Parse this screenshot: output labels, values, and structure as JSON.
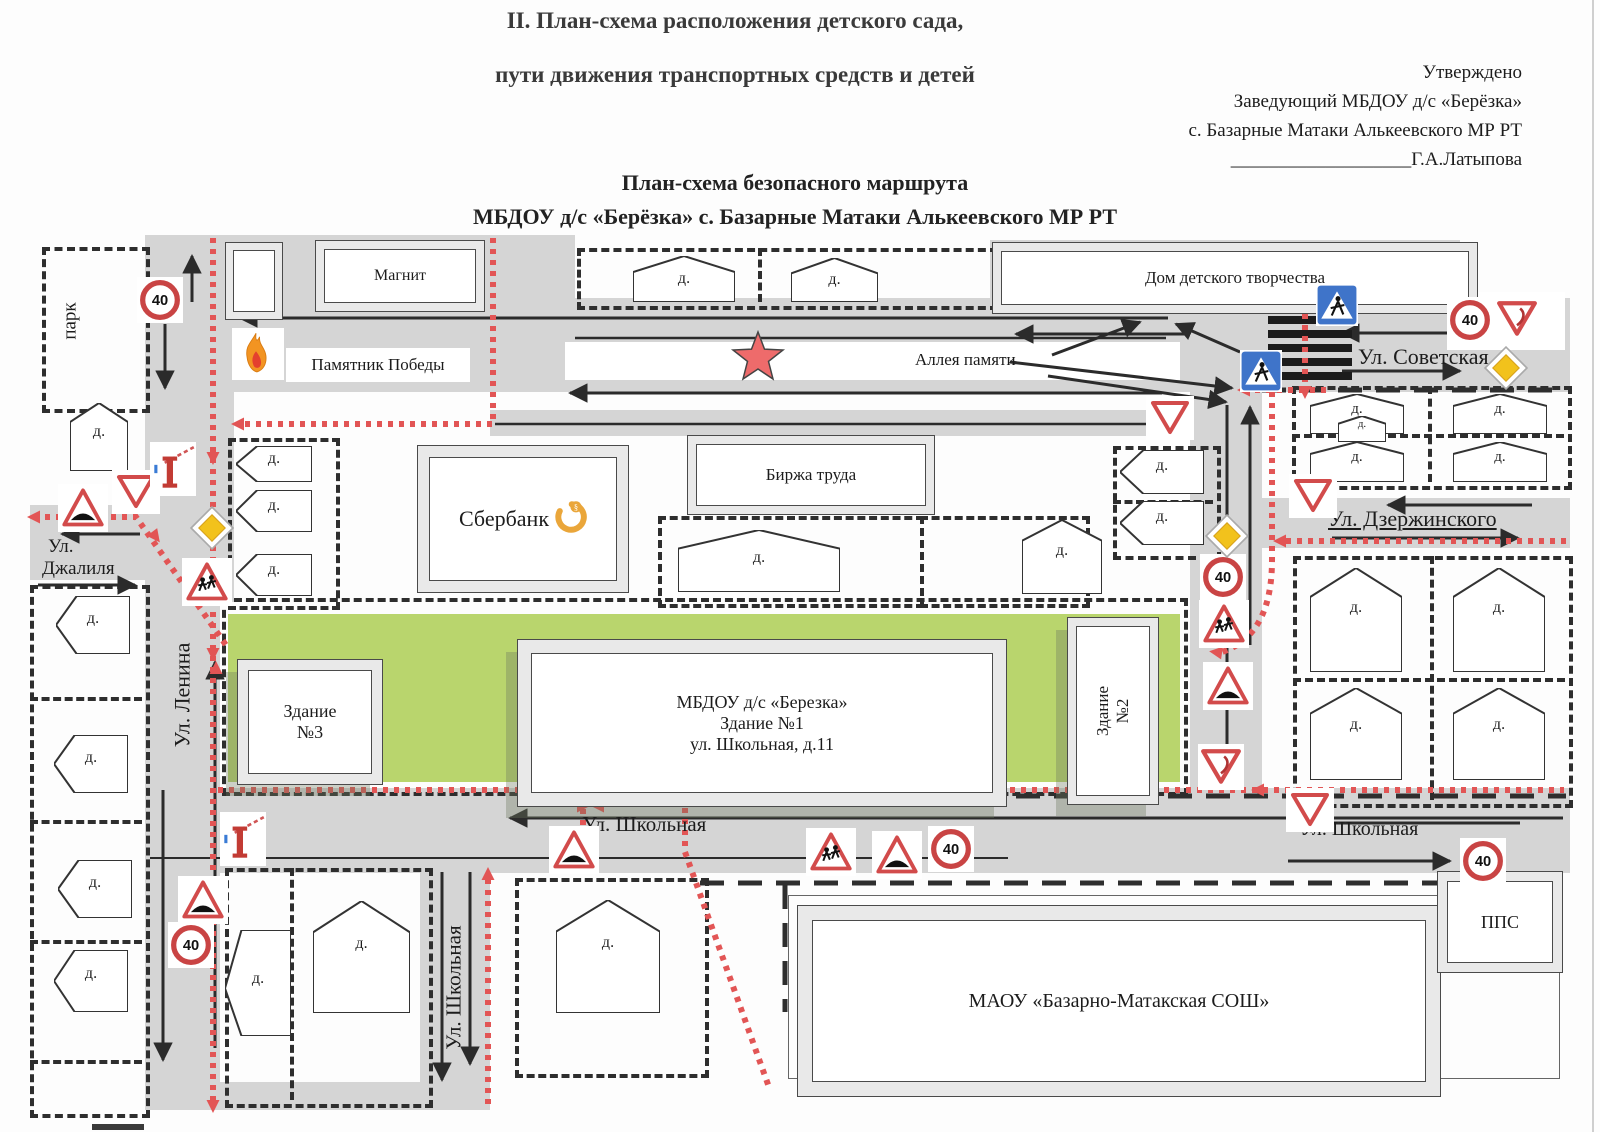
{
  "header": {
    "title_line1": "II. План-схема расположения детского сада,",
    "title_line2": "пути движения транспортных средств и детей",
    "approved": "Утверждено",
    "approved_line2": "Заведующий МБДОУ д/с «Берёзка»",
    "approved_line3": "с. Базарные Матаки Алькеевского МР РТ",
    "signature_underscores": "___________________",
    "signature_name": "Г.А.Латыпова",
    "subtitle_line1": "План-схема  безопасного маршрута",
    "subtitle_line2": "МБДОУ д/с «Берёзка» с. Базарные Матаки Алькеевского МР РТ"
  },
  "map": {
    "labels": {
      "park": "парк",
      "magnit": "Магнит",
      "pamyatnik": "Памятник Победы",
      "dom_tvorchestva": "Дом детского творчества",
      "alleya": "Аллея памяти",
      "sberbank": "Сбербанк",
      "birzha": "Биржа труда",
      "zdanie3_line1": "Здание",
      "zdanie3_line2": "№3",
      "mbdou_line1": "МБДОУ д/с «Березка»",
      "mbdou_line2": "Здание №1",
      "mbdou_line3": "ул. Школьная, д.11",
      "zdanie2": "Здание №2",
      "school": "МАОУ «Базарно-Матакская СОШ»",
      "pps": "ППС",
      "house": "д."
    },
    "streets": {
      "sovetskaya": "Ул. Советская",
      "dzerzhinskogo": "Ул. Дзержинского",
      "dzhalilya_line1": "Ул.",
      "dzhalilya_line2": "Джалиля",
      "lenina": "Ул. Ленина",
      "shkolnaya": "Ул. Школьная"
    },
    "signs": {
      "speed_limit": "40"
    },
    "colors": {
      "route_red": "#e25555",
      "sign_red": "#d24b4b",
      "crossing_blue": "#3f74c9",
      "priority_yellow": "#f2c21c",
      "road_gray": "#d5d5d5",
      "lawn_green": "#b9d56d",
      "star_red": "#ee6b6b",
      "flame_orange": "#f29422",
      "sber_orange": "#eaa63a"
    }
  }
}
